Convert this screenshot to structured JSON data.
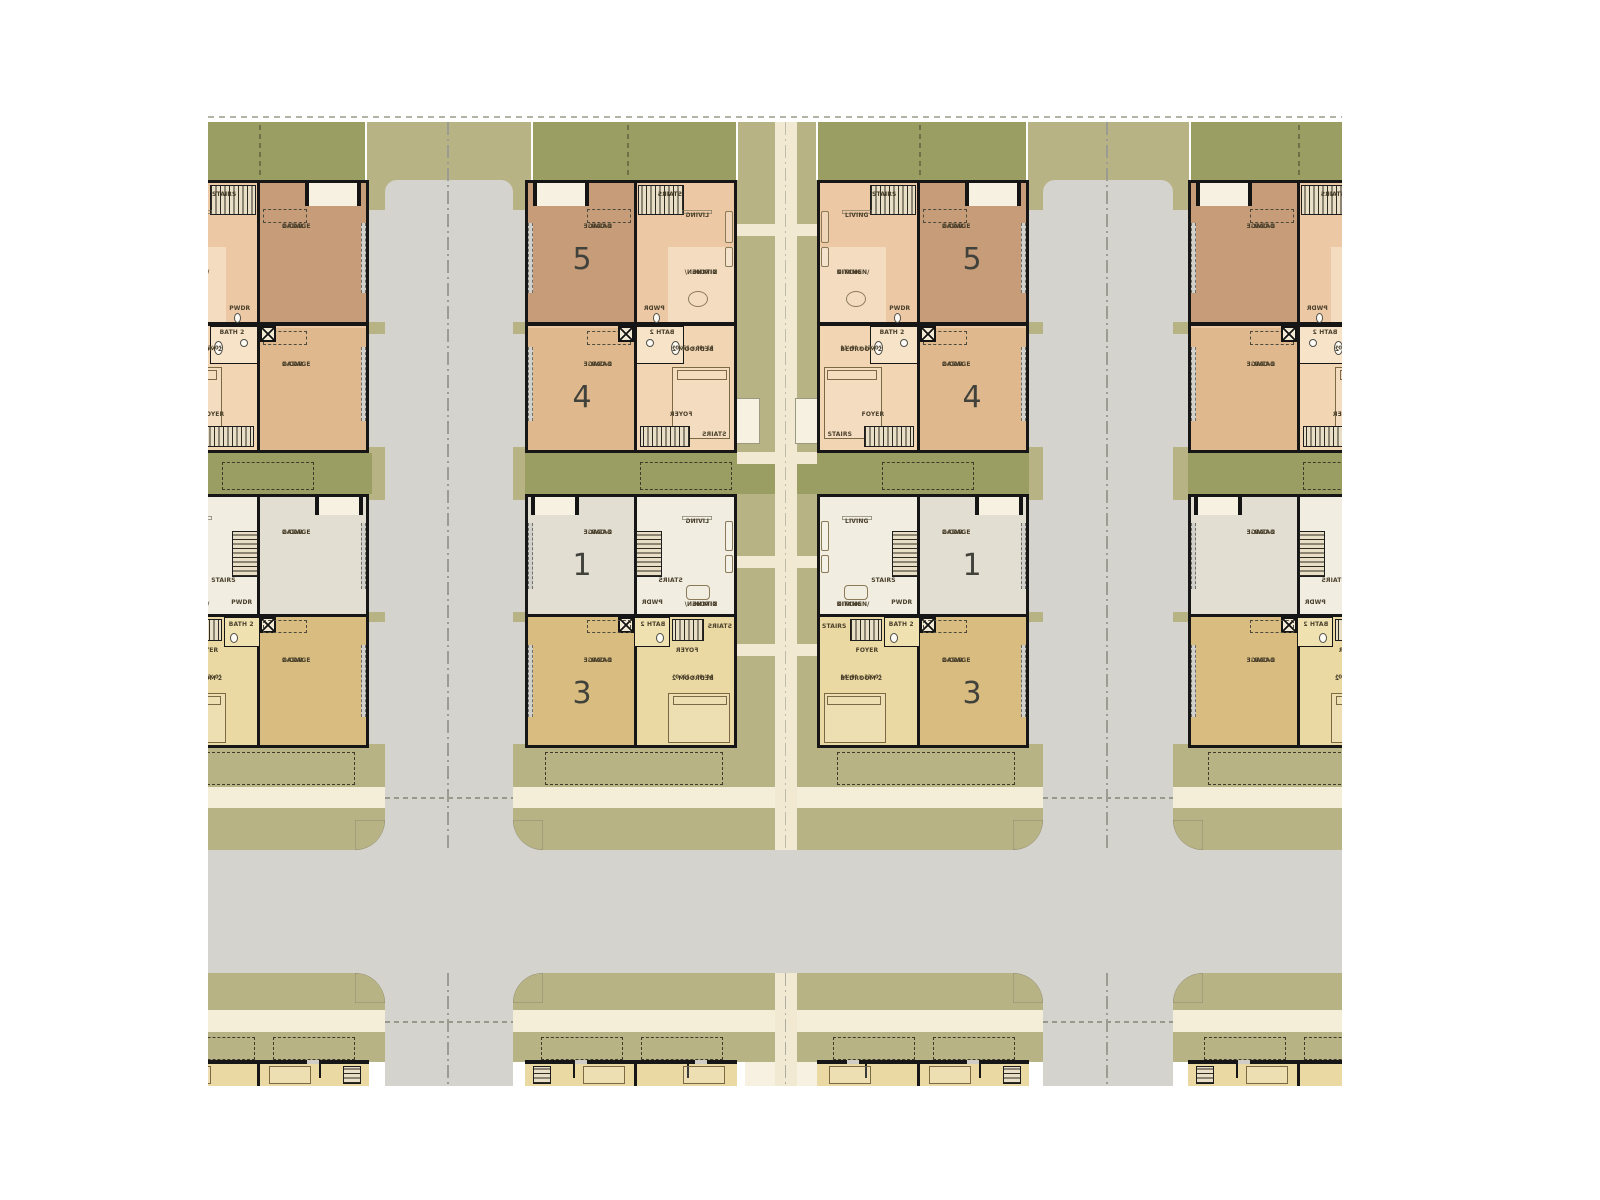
{
  "drawing": {
    "type": "townhome-site-floor-plan",
    "note": "mirrored duplicate buildings flanking streets and a central pedestrian paseo"
  },
  "labels": {
    "garage_line1": "2-CAR",
    "garage_line2": "GARAGE",
    "living": "LIVING",
    "kitchen_line1": "KITCHEN/",
    "kitchen_line2": "DINING",
    "bedroom2": "BEDROOM 2",
    "bedroom2_dims_upper": "11'-0\" x 12'-0\"",
    "bedroom2_dims_lower": "14'-0\" x 12'-0\"",
    "foyer": "FOYER",
    "stairs": "STAIRS",
    "powder": "PWDR",
    "bath": "BATH 2"
  },
  "units": {
    "garage_top_upper": "5",
    "garage_bottom_upper": "4",
    "garage_top_lower": "1",
    "garage_bottom_lower": "3"
  },
  "colors": {
    "street_gray": "#d5d3ce",
    "olive_light": "#b8b384",
    "olive_dark": "#9a9e63",
    "sidewalk_cream": "#f4edd8",
    "path_cream": "#f1e9d2",
    "porch_cream": "#f7f1e1",
    "wall_black": "#161616",
    "garage5_fill": "#c79d79",
    "garage4_fill": "#dfb98d",
    "unit5_interior": "#ecc9a4",
    "unit5_kitchen": "#f4dcc0",
    "unit4_interior": "#f2d6b4",
    "bath_fill": "#f6e3c8",
    "garage1_fill": "#e3ded2",
    "unit1_interior": "#f1ede1",
    "garage3_fill": "#d9bd80",
    "unit3_interior": "#ead9a2",
    "unit3_bath_fill": "#f0e2b0",
    "label_text": "#493f2b",
    "number_text": "#42423c",
    "centerline": "#9c9c93"
  }
}
